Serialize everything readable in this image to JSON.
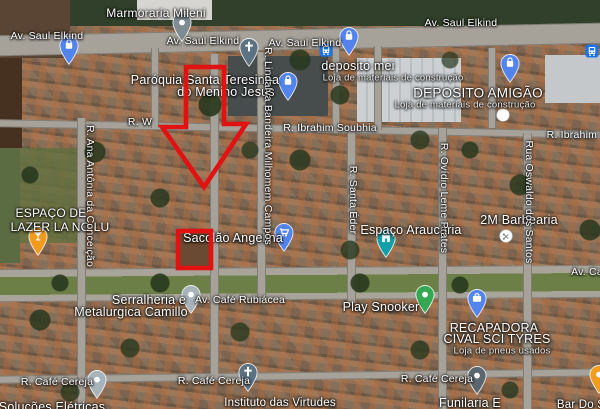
{
  "map": {
    "kind": "google-maps-satellite",
    "labels": [
      {
        "t": "Marmoraria Mileni",
        "x": 156,
        "y": 13,
        "k": "poi",
        "s": 12
      },
      {
        "t": "Av. Saul Elkind",
        "x": 47,
        "y": 36,
        "k": "street"
      },
      {
        "t": "Av. Saul Elkind",
        "x": 203,
        "y": 41,
        "k": "street"
      },
      {
        "t": "Av. Saul Elkind",
        "x": 305,
        "y": 43,
        "k": "street"
      },
      {
        "t": "Av. Saul Elkind",
        "x": 461,
        "y": 23,
        "k": "street"
      },
      {
        "t": "Paróquia Santa Teresinha",
        "x": 205,
        "y": 80,
        "k": "poi"
      },
      {
        "t": "do Menino Jesus",
        "x": 226,
        "y": 92,
        "k": "poi"
      },
      {
        "t": "deposito mei",
        "x": 358,
        "y": 66,
        "k": "poi"
      },
      {
        "t": "Loja de materiais de construção",
        "x": 393,
        "y": 78,
        "k": "sub"
      },
      {
        "t": "DEPOSITO AMIGÃO",
        "x": 478,
        "y": 93,
        "k": "poi",
        "s": 13.5
      },
      {
        "t": "Loja de materiais de construção",
        "x": 465,
        "y": 105,
        "k": "sub"
      },
      {
        "t": "R. W",
        "x": 140,
        "y": 122,
        "k": "street"
      },
      {
        "t": "R. Ibrahim Soubhia",
        "x": 330,
        "y": 128,
        "k": "street"
      },
      {
        "t": "R. Ibrahim S",
        "x": 577,
        "y": 135,
        "k": "street"
      },
      {
        "t": "ESPAÇO DE",
        "x": 51,
        "y": 213,
        "k": "poi",
        "s": 12
      },
      {
        "t": "LAZER LA NO LU",
        "x": 60,
        "y": 227,
        "k": "poi",
        "s": 12
      },
      {
        "t": "2M Barbearia",
        "x": 519,
        "y": 220,
        "k": "poi"
      },
      {
        "t": "Espaço Araucária",
        "x": 411,
        "y": 230,
        "k": "poi"
      },
      {
        "t": "Sacolão Angelina",
        "x": 233,
        "y": 238,
        "k": "poi"
      },
      {
        "t": "Av. Ca",
        "x": 587,
        "y": 272,
        "k": "street"
      },
      {
        "t": "Serralheria e",
        "x": 149,
        "y": 300,
        "k": "poi"
      },
      {
        "t": "Metalurgica Camillo",
        "x": 131,
        "y": 312,
        "k": "poi"
      },
      {
        "t": "Av. Café Rubiácea",
        "x": 240,
        "y": 300,
        "k": "street"
      },
      {
        "t": "Play Snooker",
        "x": 381,
        "y": 307,
        "k": "poi"
      },
      {
        "t": "RECAPADORA",
        "x": 494,
        "y": 328,
        "k": "poi"
      },
      {
        "t": "CIVAL SCI TYRES",
        "x": 497,
        "y": 339,
        "k": "poi"
      },
      {
        "t": "Loja de pneus usados",
        "x": 502,
        "y": 351,
        "k": "sub"
      },
      {
        "t": "R. Café Cereja",
        "x": 57,
        "y": 382,
        "k": "street"
      },
      {
        "t": "R. Café Cereja",
        "x": 214,
        "y": 381,
        "k": "street"
      },
      {
        "t": "R. Café Cereja",
        "x": 437,
        "y": 379,
        "k": "street"
      },
      {
        "t": "Soluções Elétricas",
        "x": 52,
        "y": 407,
        "k": "poi"
      },
      {
        "t": "Instituto das Virtudes",
        "x": 280,
        "y": 403,
        "k": "poi",
        "s": 11.5
      },
      {
        "t": "Funilaria E",
        "x": 470,
        "y": 403,
        "k": "poi"
      },
      {
        "t": "Bar Do S",
        "x": 581,
        "y": 405,
        "k": "poi",
        "s": 11.5
      }
    ],
    "vertical_labels": [
      {
        "t": "R. Ana Antônia da Conceição",
        "x": 90,
        "y": 196
      },
      {
        "t": "R. Lindalva Bandeira Milhomem Campos",
        "x": 268,
        "y": 146
      },
      {
        "t": "R. Santa Éder",
        "x": 353,
        "y": 200
      },
      {
        "t": "R. Ovídio Leme Prates",
        "x": 444,
        "y": 198
      },
      {
        "t": "Rua Oswaldo dos Santos",
        "x": 529,
        "y": 202
      }
    ],
    "pins": [
      {
        "n": "shopping-bag-pin",
        "x": 69,
        "y": 53,
        "c": "#5384ed",
        "g": "bag"
      },
      {
        "n": "place-pin",
        "x": 182,
        "y": 30,
        "c": "#7e8b93",
        "g": "dot"
      },
      {
        "n": "church-pin",
        "x": 249,
        "y": 55,
        "c": "#5b7282",
        "g": "cross"
      },
      {
        "n": "shopping-bag-pin",
        "x": 288,
        "y": 89,
        "c": "#5384ed",
        "g": "bag"
      },
      {
        "n": "bus-stop-icon",
        "x": 326,
        "y": 50,
        "type": "bus"
      },
      {
        "n": "shopping-bag-pin",
        "x": 349,
        "y": 44,
        "c": "#5384ed",
        "g": "bag"
      },
      {
        "n": "shopping-bag-pin",
        "x": 510,
        "y": 71,
        "c": "#5384ed",
        "g": "bag"
      },
      {
        "n": "bus-stop-icon",
        "x": 592,
        "y": 51,
        "type": "bus"
      },
      {
        "n": "poi-dot-icon",
        "x": 503,
        "y": 115,
        "type": "circle",
        "g": "dot"
      },
      {
        "n": "bar-pin",
        "x": 38,
        "y": 244,
        "c": "#f29b1d",
        "g": "glass"
      },
      {
        "n": "grocery-cart-pin",
        "x": 284,
        "y": 240,
        "c": "#5384ed",
        "g": "cart"
      },
      {
        "n": "business-pin",
        "x": 191,
        "y": 302,
        "c": "#a7b4bb",
        "g": "dot"
      },
      {
        "n": "leisure-pin",
        "x": 386,
        "y": 246,
        "c": "#12a0a8",
        "g": "building"
      },
      {
        "n": "barber-poi-icon",
        "x": 506,
        "y": 236,
        "type": "circle",
        "g": "scissors"
      },
      {
        "n": "snooker-pin",
        "x": 425,
        "y": 302,
        "c": "#34a853",
        "g": "dot"
      },
      {
        "n": "tire-shop-pin",
        "x": 477,
        "y": 306,
        "c": "#5384ed",
        "g": "briefcase"
      },
      {
        "n": "place-pin",
        "x": 97,
        "y": 387,
        "c": "#a7b4bb",
        "g": "dot"
      },
      {
        "n": "church-pin",
        "x": 248,
        "y": 380,
        "c": "#5b7282",
        "g": "cross"
      },
      {
        "n": "place-pin",
        "x": 477,
        "y": 383,
        "c": "#5b6770",
        "g": "dot"
      },
      {
        "n": "place-pin",
        "x": 599,
        "y": 382,
        "c": "#f29b1d",
        "g": "dot"
      }
    ],
    "annotations": {
      "color": "#e01212",
      "stroke_width": 4.6,
      "arrow_points": "186,67 224,67 224,124 246,124 204,187 162,127 186,127",
      "rect": {
        "x": 178,
        "y": 231,
        "w": 33,
        "h": 37
      }
    }
  }
}
